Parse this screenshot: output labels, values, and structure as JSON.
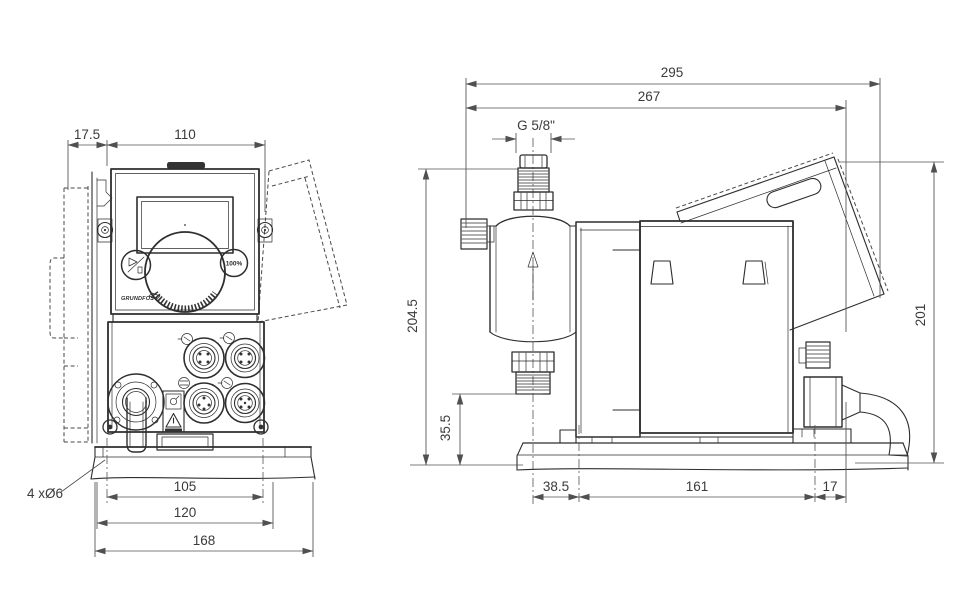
{
  "drawing_type": "dimensional-drawing-dosing-pump",
  "colors": {
    "line": "#2e2e2e",
    "dimension": "#505050",
    "background": "#ffffff"
  },
  "icons": [
    "start-stop-icon",
    "warning-triangle-icon",
    "flow-arrow-icon",
    "connector-socket-icon",
    "grundfos-logo"
  ],
  "views": {
    "front": {
      "dims": {
        "wall_offset": "17.5",
        "width": "110",
        "hole_spacing": "105",
        "plate_width": "120",
        "overall_width": "168",
        "holes_note": "4 xØ6"
      },
      "panel": {
        "max_button": "100%",
        "brand": "GRUNDFOS"
      }
    },
    "side": {
      "dims": {
        "overall_length": "295",
        "length_to_corner": "267",
        "thread": "G 5/8\"",
        "overall_height": "204.5",
        "suction_height": "35.5",
        "body_height": "201",
        "center_to_hole": "38.5",
        "hole_spacing": "161",
        "rear_offset": "17"
      }
    }
  }
}
